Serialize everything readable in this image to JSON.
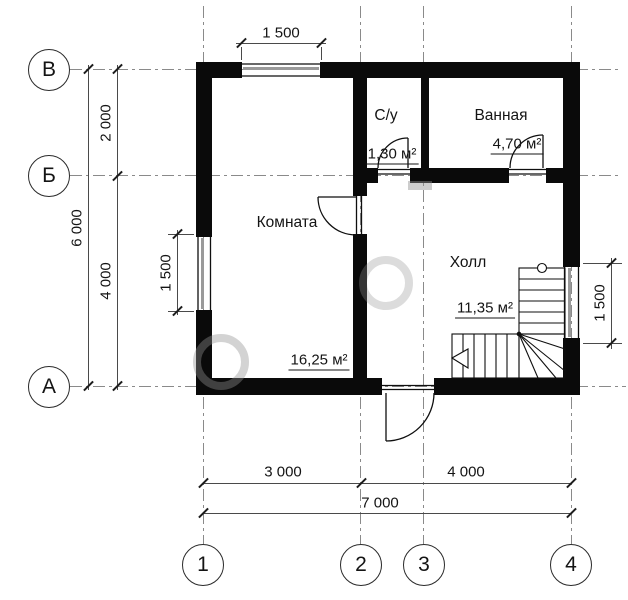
{
  "drawing": {
    "rooms": [
      {
        "name": "Комната",
        "area": "16,25 м²"
      },
      {
        "name": "С/у",
        "area": "1,30 м²"
      },
      {
        "name": "Ванная",
        "area": "4,70 м²"
      },
      {
        "name": "Холл",
        "area": "11,35 м²"
      }
    ],
    "dims": {
      "top_window": "1 500",
      "left_upper": "2 000",
      "left_total": "6 000",
      "left_lower": "4 000",
      "left_window": "1 500",
      "right_window": "1 500",
      "bottom_left": "3 000",
      "bottom_right": "4 000",
      "bottom_total": "7 000"
    },
    "axes_rows": [
      {
        "label": "В"
      },
      {
        "label": "Б"
      },
      {
        "label": "А"
      }
    ],
    "axes_cols": [
      {
        "label": "1"
      },
      {
        "label": "2"
      },
      {
        "label": "3"
      },
      {
        "label": "4"
      }
    ],
    "colors": {
      "wall": "#0a0a0a",
      "dim_line": "#4a4a4a",
      "axis_line": "#8a8a8a",
      "text": "#141414"
    }
  }
}
